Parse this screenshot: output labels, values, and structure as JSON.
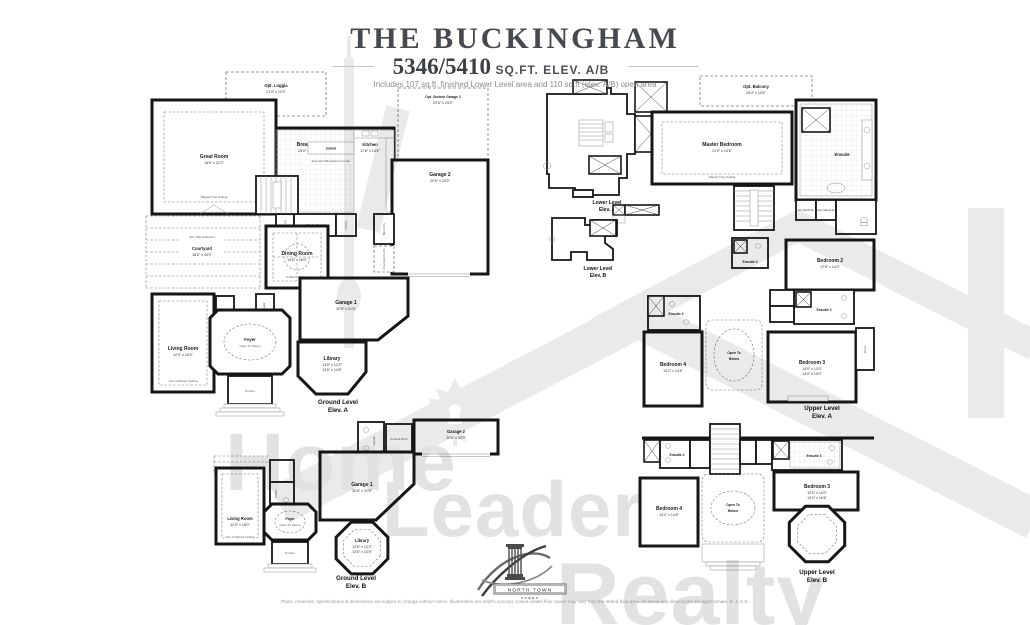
{
  "header": {
    "title": "THE BUCKINGHAM",
    "sqft": "5346/5410",
    "sqft_suffix": "SQ.FT. ELEV. A/B",
    "note": "Includes 107 sq.ft. finished Lower Level area and 110 sq.ft (elev. A/B) open area"
  },
  "plans": {
    "ground_a": {
      "level": "Ground Level",
      "elev": "Elev. A",
      "rooms": {
        "loggia": {
          "label": "Opt. Loggia",
          "dims": "21'0\" x 12'0\""
        },
        "great_room": {
          "label": "Great Room",
          "dims": "16'6\" x 22'0\"",
          "note": "Raised Tray Ceiling"
        },
        "breakfast": {
          "label": "Breakfast",
          "dims": "20'0\" x 14'6\""
        },
        "kitchen": {
          "label": "Kitchen",
          "dims": "17'6\" x 14'6\""
        },
        "island": {
          "label": "Island"
        },
        "counter_note": "Extended Breakfast Counter",
        "sunken_garage": {
          "label": "Opt. Sunken Garage 2",
          "dims": "20'6\" x 23'0\""
        },
        "garage2": {
          "label": "Garage 2",
          "dims": "20'6\" x 23'0\""
        },
        "mud": {
          "label": "Mud Rm."
        },
        "covered_porch": {
          "label": "Covered Porch"
        },
        "servery": {
          "label": "Servery"
        },
        "chefs_desk": {
          "label": "Chef's Desk"
        },
        "pantry": {
          "label": "Pantry"
        },
        "powder": {
          "label": "Powder"
        },
        "dining": {
          "label": "Dining Room",
          "dims": "14'6\" x 18'0\"",
          "note": "Coffered Ceiling"
        },
        "side_entrance": {
          "label": "Opt. Side Entrance"
        },
        "courtyard": {
          "label": "Courtyard",
          "dims": "18'0\" x 44'0\""
        },
        "living": {
          "label": "Living Room",
          "dims": "12'0\" x 18'0\"",
          "note": "Opt. Coffered Ceiling"
        },
        "foyer": {
          "label": "Foyer",
          "note": "Open To Above"
        },
        "portico": {
          "label": "Portico"
        },
        "garage1": {
          "label": "Garage 1",
          "dims": "20'6\" x 21'6\""
        },
        "library": {
          "label": "Library",
          "dims1": "13'6\" x 12'2\"",
          "dims2": "13'6\" x 14'8\""
        }
      }
    },
    "lower_a": {
      "level": "Lower Level",
      "elev": "Elev. A"
    },
    "lower_b": {
      "level": "Lower Level",
      "elev": "Elev. B"
    },
    "upper_a": {
      "level": "Upper Level",
      "elev": "Elev. A",
      "rooms": {
        "balcony": {
          "label": "Opt. Balcony",
          "dims": "20'4\" x 10'6\""
        },
        "master": {
          "label": "Master Bedroom",
          "dims": "21'0\" x 14'6\"",
          "note": "Raised Tray Ceiling"
        },
        "ensuite": {
          "label": "Ensuite"
        },
        "his_wardrobe": {
          "label": "His Wardrobe"
        },
        "hers_wardrobe": {
          "label": "Hers Wardrobe"
        },
        "ensuite2": {
          "label": "Ensuite 2"
        },
        "bedroom2": {
          "label": "Bedroom 2",
          "dims": "17'8\" x 14'2\""
        },
        "ensuite3": {
          "label": "Ensuite 3"
        },
        "ensuite4": {
          "label": "Ensuite 4"
        },
        "bedroom4": {
          "label": "Bedroom 4",
          "dims": "13'2\" x 14'8\""
        },
        "open_below": {
          "line1": "Open To",
          "line2": "Below"
        },
        "bedroom3": {
          "label": "Bedroom 3",
          "dims1": "14'0\" x 13'0\"",
          "dims2": "14'0\" x 15'0\""
        },
        "wic": {
          "label": "W.I.C."
        }
      }
    },
    "ground_b": {
      "level": "Ground Level",
      "elev": "Elev. B",
      "rooms": {
        "laundry": {
          "label": "Laundry"
        },
        "covered_porch": {
          "label": "Covered Porch"
        },
        "garage2": {
          "label": "Garage 2",
          "dims": "20'6\" x 23'0\""
        },
        "garage1": {
          "label": "Garage 1",
          "dims": "20'6\" x 21'6\""
        },
        "powder": {
          "label": "Powder"
        },
        "living": {
          "label": "Living Room",
          "dims": "12'0\" x 18'0\"",
          "note": "Opt. Coffered Ceiling"
        },
        "foyer": {
          "label": "Foyer",
          "note": "Open To Above"
        },
        "portico": {
          "label": "Portico"
        },
        "library": {
          "label": "Library",
          "dims1": "13'6\" x 12'2\"",
          "dims2": "13'6\" x 14'8\""
        }
      }
    },
    "upper_b": {
      "level": "Upper Level",
      "elev": "Elev. B",
      "rooms": {
        "ensuite4": {
          "label": "Ensuite 4"
        },
        "ensuite3": {
          "label": "Ensuite 3"
        },
        "bedroom4": {
          "label": "Bedroom 4",
          "dims": "13'2\" x 14'8\""
        },
        "open_below": {
          "line1": "Open To",
          "line2": "Below"
        },
        "bedroom3": {
          "label": "Bedroom 3",
          "dims1": "13'0\" x 13'0\"",
          "dims2": "13'0\" x 16'6\""
        }
      }
    }
  },
  "watermark": {
    "word1": "Home",
    "word2": "Leader",
    "word3": "Realty"
  },
  "logo": {
    "name": "NORTH TOWN",
    "sub": "HOMES"
  },
  "footer": {
    "disclaimer": "Plans, materials, specifications & dimensions are subject to change without notice. Illustrations are artist's concept. Actual usable floor space may vary from the stated floor area. All areas and dimensions are approximate. E. & O.E."
  }
}
